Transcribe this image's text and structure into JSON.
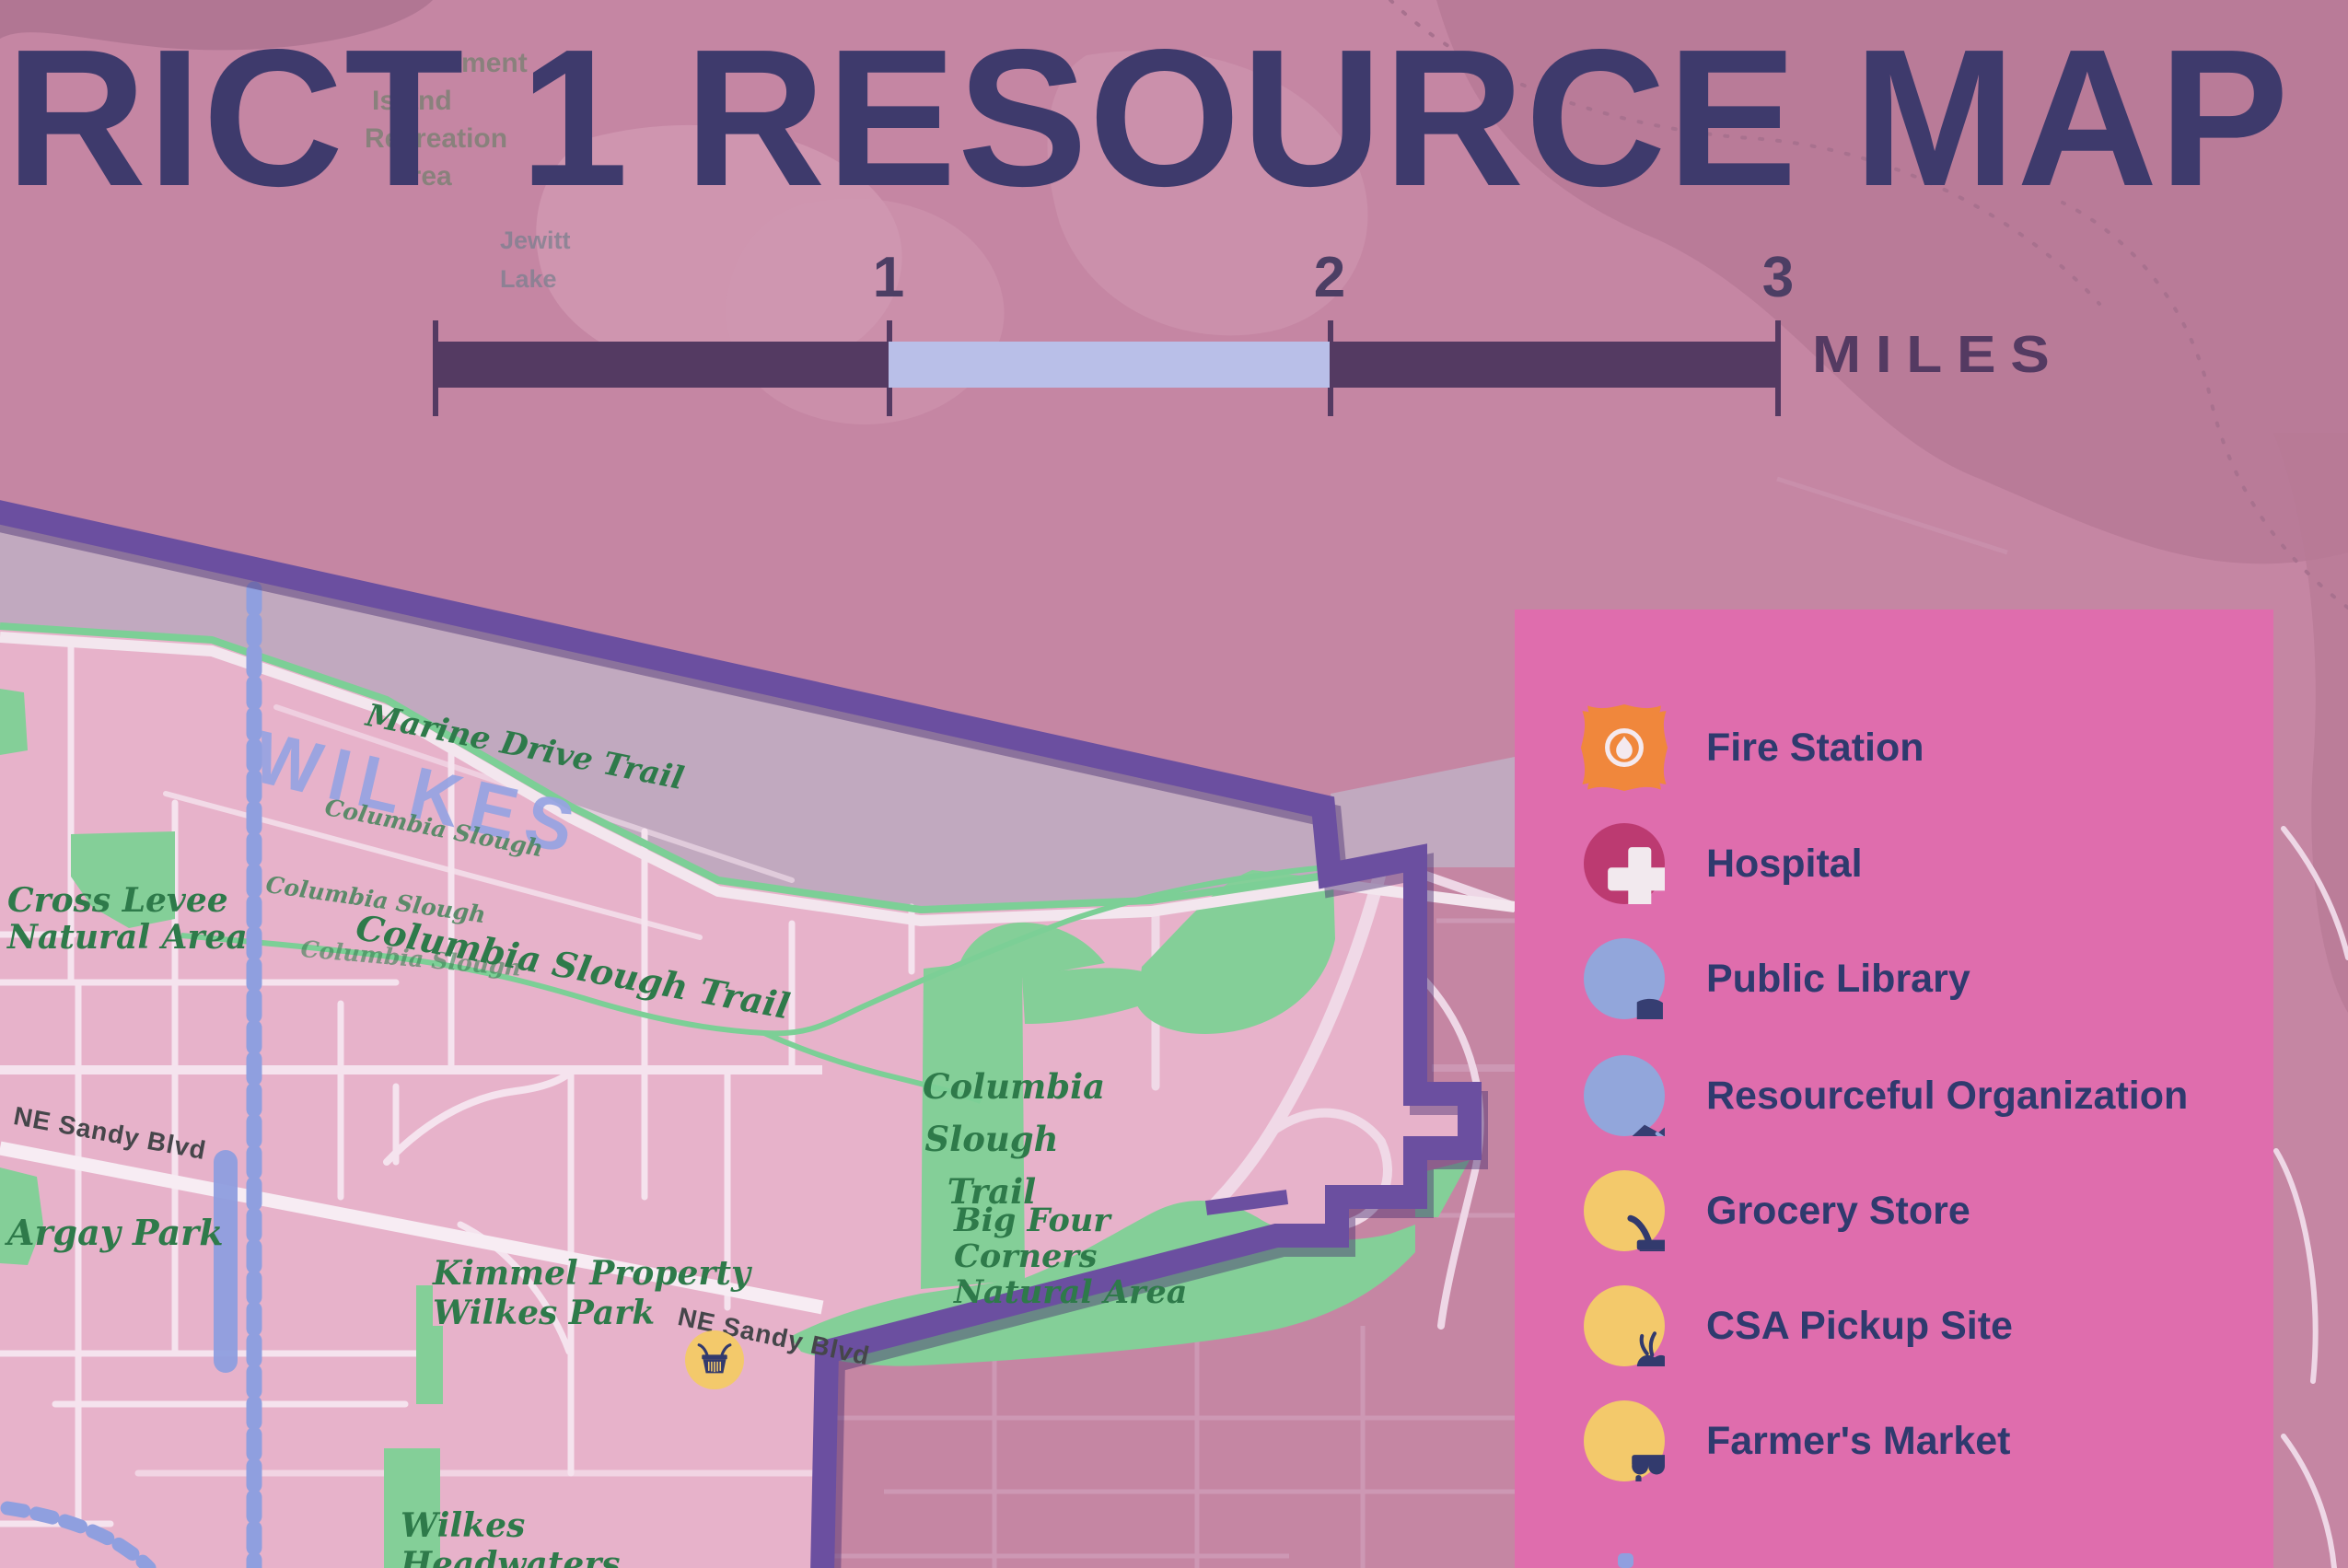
{
  "title": "RICT 1 RESOURCE MAP",
  "background_labels": {
    "recreation_area": [
      "Government",
      "Island",
      "Recreation",
      "Area"
    ],
    "lake": [
      "Jewitt",
      "Lake"
    ]
  },
  "scale_bar": {
    "tick_1": "1",
    "tick_2": "2",
    "tick_3": "3",
    "unit": "MILES"
  },
  "legend": {
    "items": [
      {
        "label": "Fire Station",
        "icon": "fire-station-icon",
        "color": "#f0873c"
      },
      {
        "label": "Hospital",
        "icon": "hospital-icon",
        "color": "#bc3a71"
      },
      {
        "label": "Public Library",
        "icon": "public-library-icon",
        "color": "#92a6db"
      },
      {
        "label": "Resourceful Organization",
        "icon": "handshake-icon",
        "color": "#92a6db"
      },
      {
        "label": "Grocery Store",
        "icon": "grocery-basket-icon",
        "color": "#f3c96b"
      },
      {
        "label": "CSA Pickup Site",
        "icon": "csa-produce-icon",
        "color": "#f3c96b"
      },
      {
        "label": "Farmer's Market",
        "icon": "market-stall-icon",
        "color": "#f3c96b"
      }
    ]
  },
  "map_labels": {
    "neighborhood": "WILKES",
    "marine_drive_trail": "Marine Drive Trail",
    "columbia_slough": "Columbia Slough",
    "columbia_slough_trail": "Columbia Slough Trail",
    "columbia_slough_trail_lines": [
      "Columbia",
      "Slough",
      "Trail"
    ],
    "cross_levee_natural_area": [
      "Cross Levee",
      "Natural Area"
    ],
    "big_four_corners": [
      "Big Four",
      "Corners",
      "Natural Area"
    ],
    "argay_park": "Argay Park",
    "kimmel_property": [
      "Kimmel Property",
      "Wilkes Park"
    ],
    "wilkes_headwaters": [
      "Wilkes",
      "Headwaters"
    ],
    "ne_sandy_blvd": "NE Sandy Blvd"
  },
  "colors": {
    "background": "#c586a3",
    "district_fill": "#e7b2ca",
    "boundary": "#6b4fa0",
    "legend_panel": "#df6dad",
    "park_green": "#84cf98",
    "label_green": "#2e7a4a",
    "navy": "#2f3a6e",
    "periwinkle": "#8f9fdf",
    "scale_dark": "#543a62",
    "scale_light": "#b9bfe8",
    "title_navy": "#3e3a6c"
  }
}
